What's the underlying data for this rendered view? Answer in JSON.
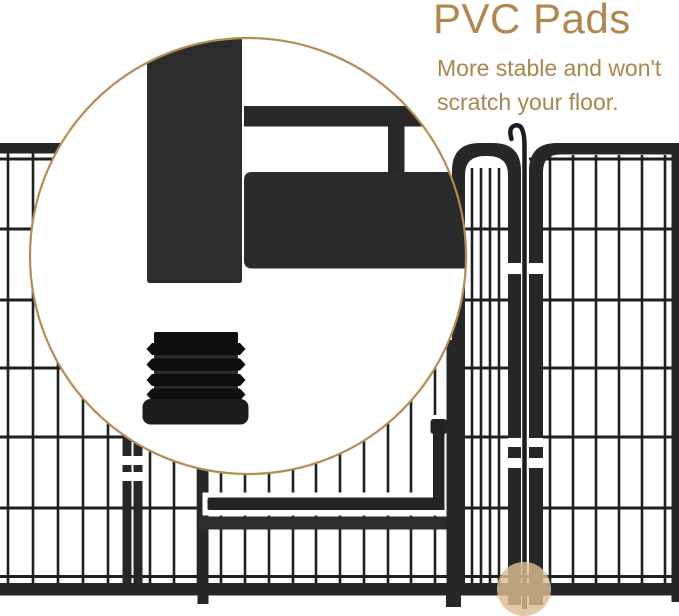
{
  "title": "PVC Pads",
  "subtitle": {
    "line1": "More stable and won't",
    "line2": "scratch your floor."
  },
  "icons": {
    "magnifier": "magnifier-circle",
    "pad": "pvc-pad-cap",
    "highlight": "pad-location-highlight"
  },
  "colors": {
    "accent_text": "#b0874e",
    "subtitle_text": "#a9854f",
    "circle_border": "#b28c55",
    "frame": "#272727",
    "frame_light": "#2c2c2c",
    "wire": "#1f1f1f",
    "pad_dark": "#0e0e0e",
    "pad_core": "#191919",
    "pad_base": "#1d1d1d",
    "pad_groove": "#2e2e2e",
    "highlight_spot": "#dcbd92",
    "background": "#ffffff"
  }
}
